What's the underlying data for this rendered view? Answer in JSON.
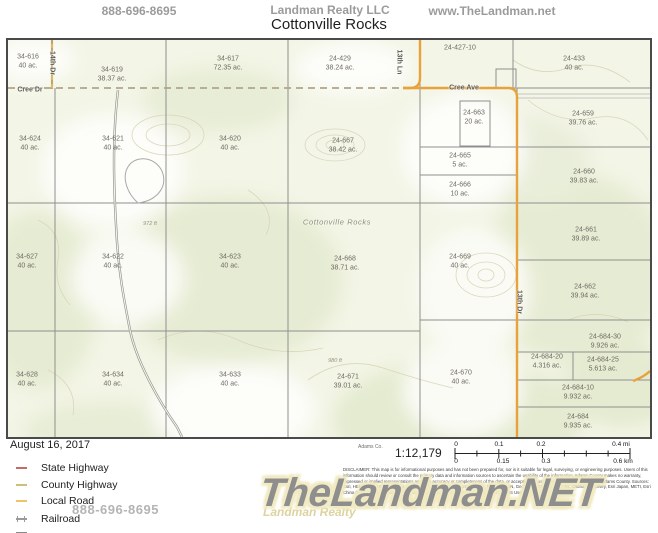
{
  "header": {
    "phone": "888-696-8695",
    "brand": "Landman Realty LLC",
    "website": "www.TheLandman.net",
    "title": "Cottonville Rocks"
  },
  "map": {
    "parcels": [
      {
        "id": "34-616",
        "acres": "40 ac.",
        "x": 20,
        "y": 22
      },
      {
        "id": "34-619",
        "acres": "38.37 ac.",
        "x": 104,
        "y": 35
      },
      {
        "id": "34-617",
        "acres": "72.35 ac.",
        "x": 220,
        "y": 24
      },
      {
        "id": "24-429",
        "acres": "38.24 ac.",
        "x": 332,
        "y": 24
      },
      {
        "id": "24-427-10",
        "acres": "",
        "x": 452,
        "y": 8
      },
      {
        "id": "24-433",
        "acres": "40 ac.",
        "x": 566,
        "y": 24
      },
      {
        "id": "34-624",
        "acres": "40 ac.",
        "x": 22,
        "y": 104
      },
      {
        "id": "34-621",
        "acres": "40 ac.",
        "x": 105,
        "y": 104
      },
      {
        "id": "34-620",
        "acres": "40 ac.",
        "x": 222,
        "y": 104
      },
      {
        "id": "24-667",
        "acres": "38.42 ac.",
        "x": 335,
        "y": 106
      },
      {
        "id": "24-663",
        "acres": "20 ac.",
        "x": 466,
        "y": 78
      },
      {
        "id": "24-659",
        "acres": "39.76 ac.",
        "x": 575,
        "y": 79
      },
      {
        "id": "24-665",
        "acres": "5 ac.",
        "x": 452,
        "y": 121
      },
      {
        "id": "24-666",
        "acres": "10 ac.",
        "x": 452,
        "y": 150
      },
      {
        "id": "24-660",
        "acres": "39.83 ac.",
        "x": 576,
        "y": 137
      },
      {
        "id": "34-627",
        "acres": "40 ac.",
        "x": 19,
        "y": 222
      },
      {
        "id": "34-622",
        "acres": "40 ac.",
        "x": 105,
        "y": 222
      },
      {
        "id": "34-623",
        "acres": "40 ac.",
        "x": 222,
        "y": 222
      },
      {
        "id": "24-668",
        "acres": "38.71 ac.",
        "x": 337,
        "y": 224
      },
      {
        "id": "24-661",
        "acres": "39.89 ac.",
        "x": 578,
        "y": 195
      },
      {
        "id": "24-669",
        "acres": "40 ac.",
        "x": 452,
        "y": 222
      },
      {
        "id": "24-662",
        "acres": "39.94 ac.",
        "x": 577,
        "y": 252
      },
      {
        "id": "34-628",
        "acres": "40 ac.",
        "x": 19,
        "y": 340
      },
      {
        "id": "34-634",
        "acres": "40 ac.",
        "x": 105,
        "y": 340
      },
      {
        "id": "34-633",
        "acres": "40 ac.",
        "x": 222,
        "y": 340
      },
      {
        "id": "24-671",
        "acres": "39.01 ac.",
        "x": 340,
        "y": 342
      },
      {
        "id": "24-670",
        "acres": "40 ac.",
        "x": 453,
        "y": 338
      },
      {
        "id": "24-684-30",
        "acres": "9.926 ac.",
        "x": 597,
        "y": 302
      },
      {
        "id": "24-684-20",
        "acres": "4.316 ac.",
        "x": 539,
        "y": 322
      },
      {
        "id": "24-684-25",
        "acres": "5.613 ac.",
        "x": 595,
        "y": 325
      },
      {
        "id": "24-684-10",
        "acres": "9.932 ac.",
        "x": 570,
        "y": 353
      },
      {
        "id": "24-684",
        "acres": "9.935 ac.",
        "x": 570,
        "y": 382
      }
    ],
    "road_labels": [
      {
        "text": "14th Dr",
        "x": 44,
        "y": 23,
        "rot": true
      },
      {
        "text": "Cree Dr",
        "x": 22,
        "y": 50,
        "rot": false
      },
      {
        "text": "13th Ln",
        "x": 391,
        "y": 22,
        "rot": true
      },
      {
        "text": "Cree Ave",
        "x": 456,
        "y": 48,
        "rot": false
      },
      {
        "text": "13th Dr",
        "x": 511,
        "y": 262,
        "rot": true
      }
    ],
    "place_label": {
      "text": "Cottonville Rocks",
      "x": 329,
      "y": 182
    },
    "elevation_labels": [
      {
        "text": "972 ft",
        "x": 142,
        "y": 184
      },
      {
        "text": "980 ft",
        "x": 327,
        "y": 321
      }
    ]
  },
  "footer": {
    "date": "August 16, 2017",
    "legend": [
      {
        "label": "State Highway",
        "color": "#c96a62",
        "type": "road",
        "y": 462
      },
      {
        "label": "County Highway",
        "color": "#cfbf75",
        "type": "road",
        "y": 479
      },
      {
        "label": "Local Road",
        "color": "#eec46a",
        "type": "road",
        "y": 495
      },
      {
        "label": "Railroad",
        "color": "#9a9a9a",
        "type": "railroad",
        "y": 513
      },
      {
        "label": "",
        "color": "#8a8a8a",
        "type": "road",
        "y": 527
      }
    ],
    "county_label": "Adams Co.",
    "scale_ratio": "1:12,179",
    "scale_mi": [
      {
        "t": "0",
        "x": 456,
        "y": 441
      },
      {
        "t": "0.1",
        "x": 499,
        "y": 441
      },
      {
        "t": "0.2",
        "x": 541,
        "y": 441
      },
      {
        "t": "0.4 mi",
        "x": 621,
        "y": 441
      }
    ],
    "scale_km": [
      {
        "t": "0",
        "x": 456,
        "y": 458
      },
      {
        "t": "0.15",
        "x": 503,
        "y": 458
      },
      {
        "t": "0.3",
        "x": 546,
        "y": 458
      },
      {
        "t": "0.6 km",
        "x": 623,
        "y": 458
      }
    ],
    "disclaimer": "DISCLAIMER: This map is for informational purposes and has not been prepared for, nor is it suitable for legal, surveying, or engineering purposes. Users of this information should review or consult the primary data and information sources to ascertain the usability of the information. Adams County makes no warranty, expressed or implied representations as to the accuracy or completeness of the data, or accepting the usability thereof. Copyright 2015, Adams County. Sources: Esri, HERE, DeLorme, Intermap, increment P Corp., GEBCO, USGS, FAO, NPS, NRCAN, GeoBase, IGN, Kadaster NL, Ordnance Survey, Esri Japan, METI, Esri China (Hong Kong), swisstopo, MapmyIndia, © OpenStreetMap contributors, and the GIS User Community",
    "watermark_phone": "888-696-8695",
    "watermark_main": "TheLandman.NET",
    "watermark_sub": "Landman Realty"
  }
}
